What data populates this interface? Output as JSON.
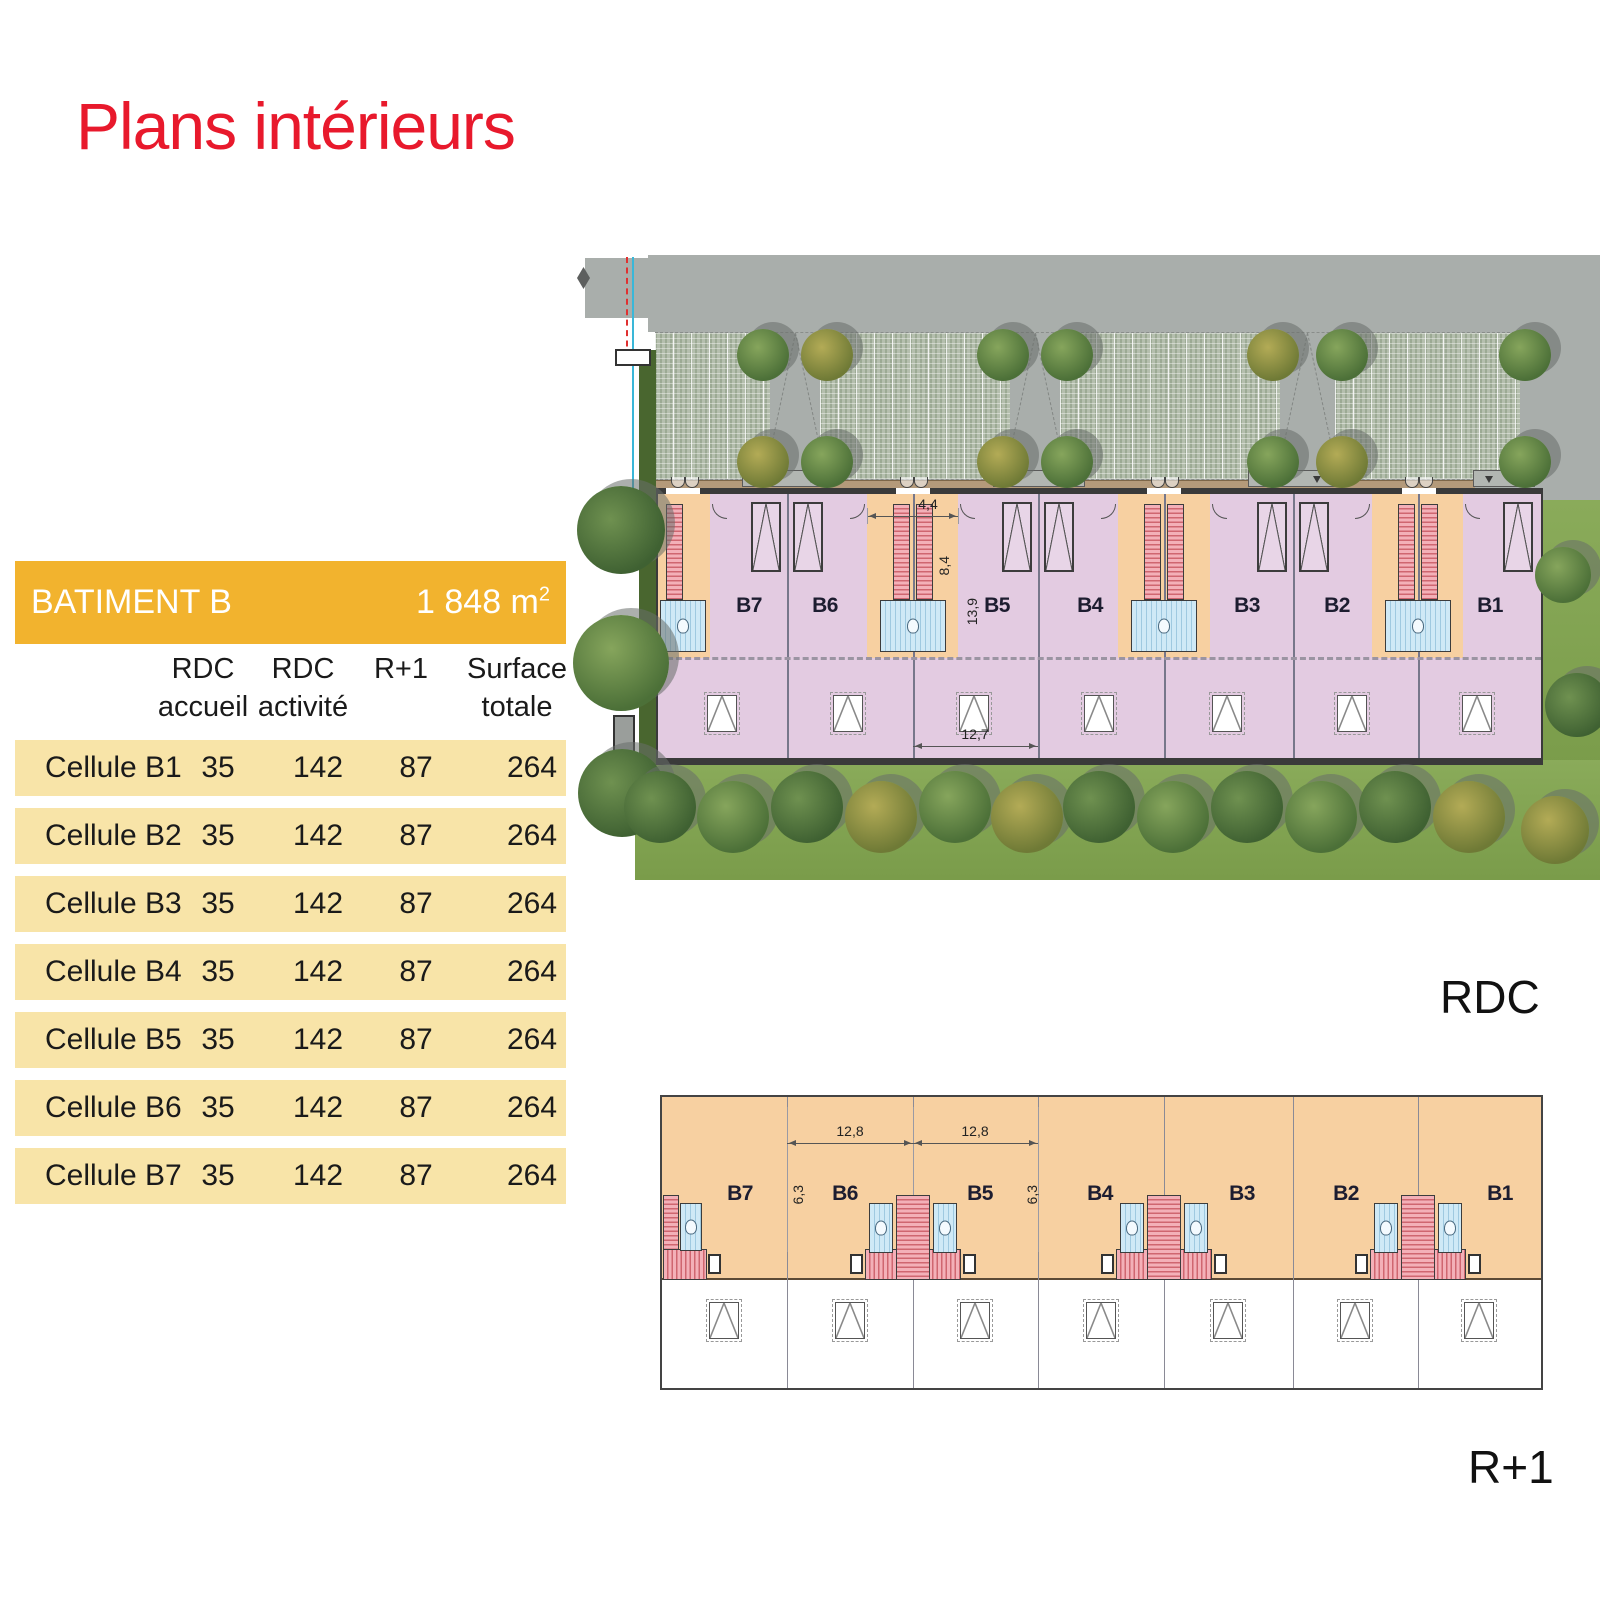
{
  "page": {
    "title": "Plans intérieurs"
  },
  "table": {
    "title": "BATIMENT B",
    "total_area": "1 848 m",
    "total_area_exponent": "2",
    "columns": [
      {
        "line1": "RDC",
        "line2": "accueil"
      },
      {
        "line1": "RDC",
        "line2": "activité"
      },
      {
        "line1": "R+1",
        "line2": ""
      },
      {
        "line1": "Surface",
        "line2": "totale"
      }
    ],
    "rows": [
      {
        "label": "Cellule B1",
        "values": [
          "35",
          "142",
          "87",
          "264"
        ]
      },
      {
        "label": "Cellule B2",
        "values": [
          "35",
          "142",
          "87",
          "264"
        ]
      },
      {
        "label": "Cellule B3",
        "values": [
          "35",
          "142",
          "87",
          "264"
        ]
      },
      {
        "label": "Cellule B4",
        "values": [
          "35",
          "142",
          "87",
          "264"
        ]
      },
      {
        "label": "Cellule B5",
        "values": [
          "35",
          "142",
          "87",
          "264"
        ]
      },
      {
        "label": "Cellule B6",
        "values": [
          "35",
          "142",
          "87",
          "264"
        ]
      },
      {
        "label": "Cellule B7",
        "values": [
          "35",
          "142",
          "87",
          "264"
        ]
      }
    ]
  },
  "plans": {
    "rdc": {
      "floor_label": "RDC",
      "cells": [
        "B7",
        "B6",
        "B5",
        "B4",
        "B3",
        "B2",
        "B1"
      ],
      "dims": {
        "entrance_width": "4,4",
        "entrance_depth": "8,4",
        "building_depth": "13,9",
        "cell_width": "12,7"
      }
    },
    "r1": {
      "floor_label": "R+1",
      "cells": [
        "B7",
        "B6",
        "B5",
        "B4",
        "B3",
        "B2",
        "B1"
      ],
      "dims": {
        "cell_width_b6": "12,8",
        "cell_width_b5": "12,8",
        "mezzanine_depth_left": "6,3",
        "mezzanine_depth_right": "6,3"
      }
    }
  },
  "colors": {
    "accent_red": "#e8192c",
    "header_gold": "#f2b32e",
    "row_yellow": "#f8e4a8",
    "cell_pink": "#e3cbe1",
    "cell_orange": "#f7d0a1",
    "grass_green": "#7fa24c",
    "road_gray": "#a9aeab"
  }
}
